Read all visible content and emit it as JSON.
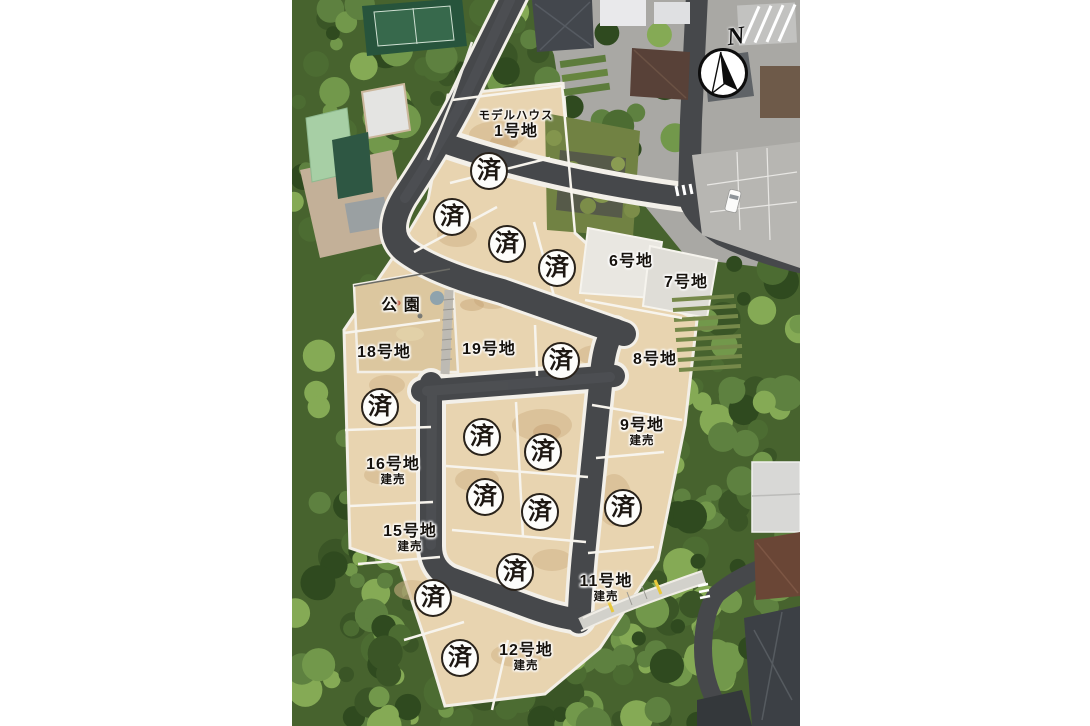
{
  "map": {
    "description_labels": {
      "park_id": "park",
      "sold_glyph": "済"
    },
    "compass": {
      "letter": "N"
    },
    "badges": {
      "glyph": "済",
      "count": 14,
      "positions": [
        [
          489,
          171
        ],
        [
          452,
          217
        ],
        [
          507,
          244
        ],
        [
          557,
          268
        ],
        [
          561,
          361
        ],
        [
          380,
          407
        ],
        [
          482,
          437
        ],
        [
          543,
          452
        ],
        [
          485,
          497
        ],
        [
          540,
          512
        ],
        [
          623,
          508
        ],
        [
          515,
          572
        ],
        [
          433,
          598
        ],
        [
          460,
          658
        ]
      ]
    },
    "labels": [
      {
        "id": "lot-1",
        "small": "モデルハウス",
        "small_position": "above",
        "big": "1号地",
        "x": 516,
        "y": 126
      },
      {
        "id": "lot-6",
        "big": "6号地",
        "x": 631,
        "y": 262
      },
      {
        "id": "lot-7",
        "big": "7号地",
        "x": 686,
        "y": 283
      },
      {
        "id": "park",
        "big": "公 園",
        "x": 401,
        "y": 306
      },
      {
        "id": "lot-18",
        "big": "18号地",
        "x": 384,
        "y": 353
      },
      {
        "id": "lot-19",
        "big": "19号地",
        "x": 489,
        "y": 350
      },
      {
        "id": "lot-8",
        "big": "8号地",
        "x": 655,
        "y": 360
      },
      {
        "id": "lot-9",
        "big": "9号地",
        "small": "建売",
        "small_position": "below",
        "x": 642,
        "y": 433
      },
      {
        "id": "lot-16",
        "big": "16号地",
        "small": "建売",
        "small_position": "below",
        "x": 393,
        "y": 472
      },
      {
        "id": "lot-15",
        "big": "15号地",
        "small": "建売",
        "small_position": "below",
        "x": 410,
        "y": 539
      },
      {
        "id": "lot-11",
        "big": "11号地",
        "small": "建売",
        "small_position": "below",
        "x": 606,
        "y": 589
      },
      {
        "id": "lot-12",
        "big": "12号地",
        "small": "建売",
        "small_position": "below",
        "x": 526,
        "y": 658
      }
    ],
    "colors": {
      "page_background": "#ffffff",
      "forest_base": "#47632e",
      "earth_lot": "#e8d4b0",
      "road": "#46484b",
      "lot_line": "#f4f1e9",
      "concrete_lot": "#e7e5df",
      "badge_border": "#29221a",
      "label_text": "#16120d"
    }
  }
}
